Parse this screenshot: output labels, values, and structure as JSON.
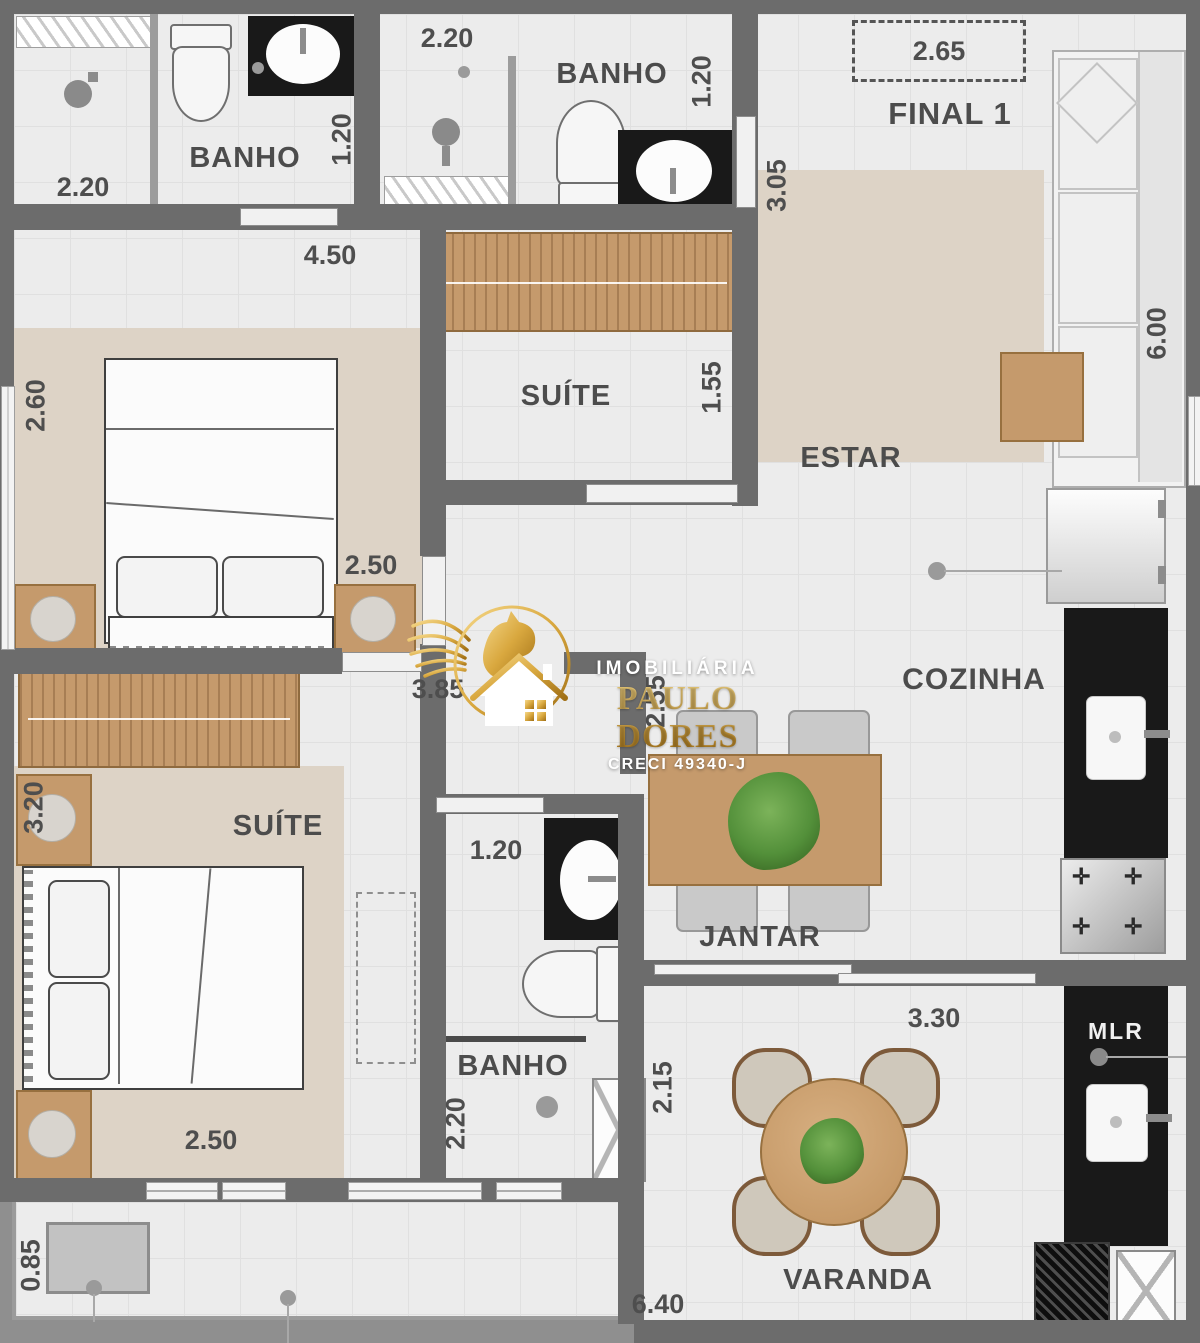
{
  "watermark": {
    "line1": "IMOBILIÁRIA",
    "line2": "PAULO DORES",
    "line3": "CRECI 49340-J"
  },
  "rooms": {
    "banho_suite2": "BANHO",
    "banho_suite1": "BANHO",
    "banho_social": "BANHO",
    "suite_top": "SUÍTE",
    "suite_lower": "SUÍTE",
    "estar": "ESTAR",
    "cozinha": "COZINHA",
    "jantar": "JANTAR",
    "varanda": "VARANDA",
    "final": "FINAL 1",
    "mlr": "MLR"
  },
  "dimensions": {
    "banho1_width": "2.20",
    "banho1_depth": "1.20",
    "banho2_width": "2.20",
    "banho2_depth": "1.20",
    "final_width": "2.65",
    "entry_depth": "3.05",
    "estar_length": "6.00",
    "suite_top_width": "4.50",
    "suite1_depth": "2.60",
    "closet_depth": "1.55",
    "suite1_width": "2.50",
    "hall_width": "3.85",
    "hall_depth": "2.55",
    "suite2_depth": "3.20",
    "banho3_width": "1.20",
    "suite2_width": "2.50",
    "banho3_depth": "2.20",
    "varanda_depth": "2.15",
    "varanda_width": "3.30",
    "varanda_length": "6.40",
    "ledge_depth": "0.85"
  },
  "colors": {
    "accent_gold": "#c89433",
    "wall": "#6c6c6c",
    "floor": "#ececec",
    "rug": "#ddd3c6",
    "wood": "#c59a6c",
    "counter_black": "#191919"
  }
}
